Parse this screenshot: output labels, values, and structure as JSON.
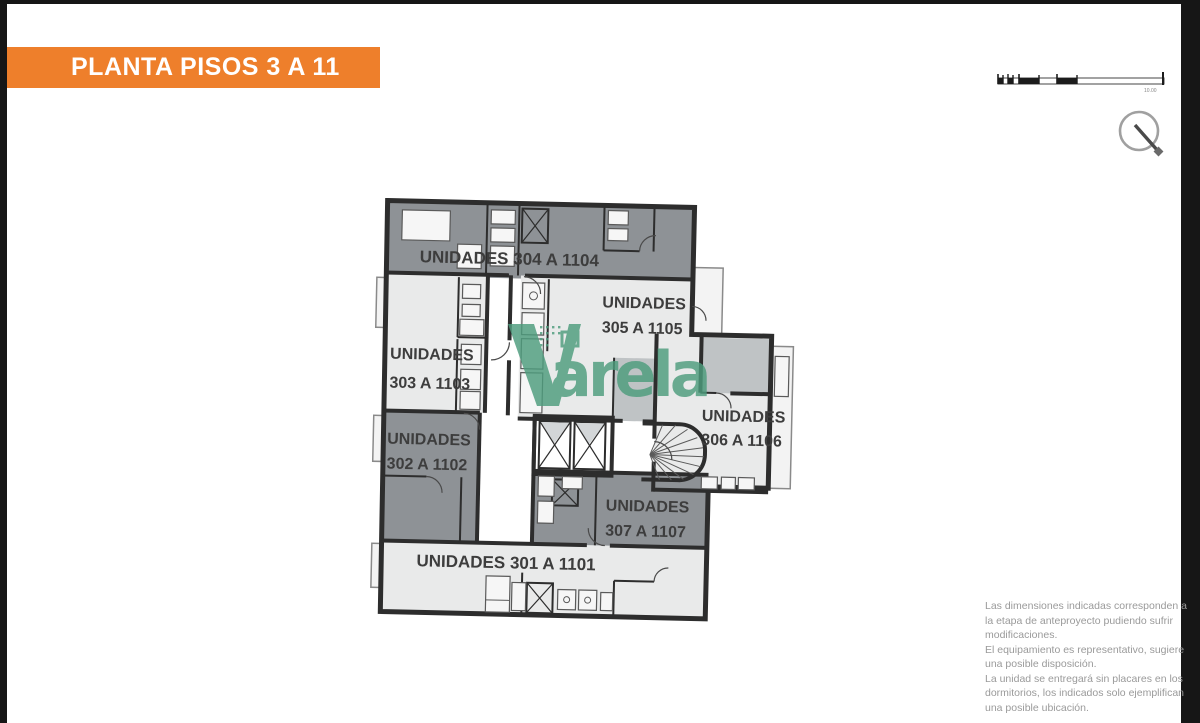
{
  "title_banner": {
    "text": "PLANTA PISOS 3 A 11"
  },
  "colors": {
    "accent_orange": "#ee7f2b",
    "watermark_green": "#4d9c7d",
    "wall_dark": "#2d2d2d",
    "unit_dark_gray": "#8e9296",
    "unit_light_gray": "#e9eaea",
    "frame_black": "#161616",
    "notes_gray": "#9a9a9a"
  },
  "plan": {
    "units": [
      {
        "id": "304",
        "label": "UNIDADES 304 A 1104",
        "shade": "dark"
      },
      {
        "id": "305",
        "line1": "UNIDADES",
        "line2": "305 A 1105",
        "shade": "light"
      },
      {
        "id": "303",
        "line1": "UNIDADES",
        "line2": "303 A 1103",
        "shade": "light"
      },
      {
        "id": "302",
        "line1": "UNIDADES",
        "line2": "302 A 1102",
        "shade": "dark"
      },
      {
        "id": "306",
        "line1": "UNIDADES",
        "line2": "306 A 1106",
        "shade": "light"
      },
      {
        "id": "307",
        "line1": "UNIDADES",
        "line2": "307 A 1107",
        "shade": "dark"
      },
      {
        "id": "301",
        "label": "UNIDADES 301 A 1101",
        "shade": "light"
      }
    ]
  },
  "watermark": {
    "initial": "V",
    "rest": "arela"
  },
  "scale_bar": {
    "end_label": "10.00"
  },
  "notes": {
    "lines": [
      "Las dimensiones indicadas corresponden a",
      "la etapa de anteproyecto pudiendo sufrir",
      "modificaciones.",
      "El equipamiento es representativo, sugiere",
      "una posible disposición.",
      "La unidad se entregará sin placares en los",
      "dormitorios, los indicados solo ejemplifican",
      "una posible ubicación."
    ]
  }
}
